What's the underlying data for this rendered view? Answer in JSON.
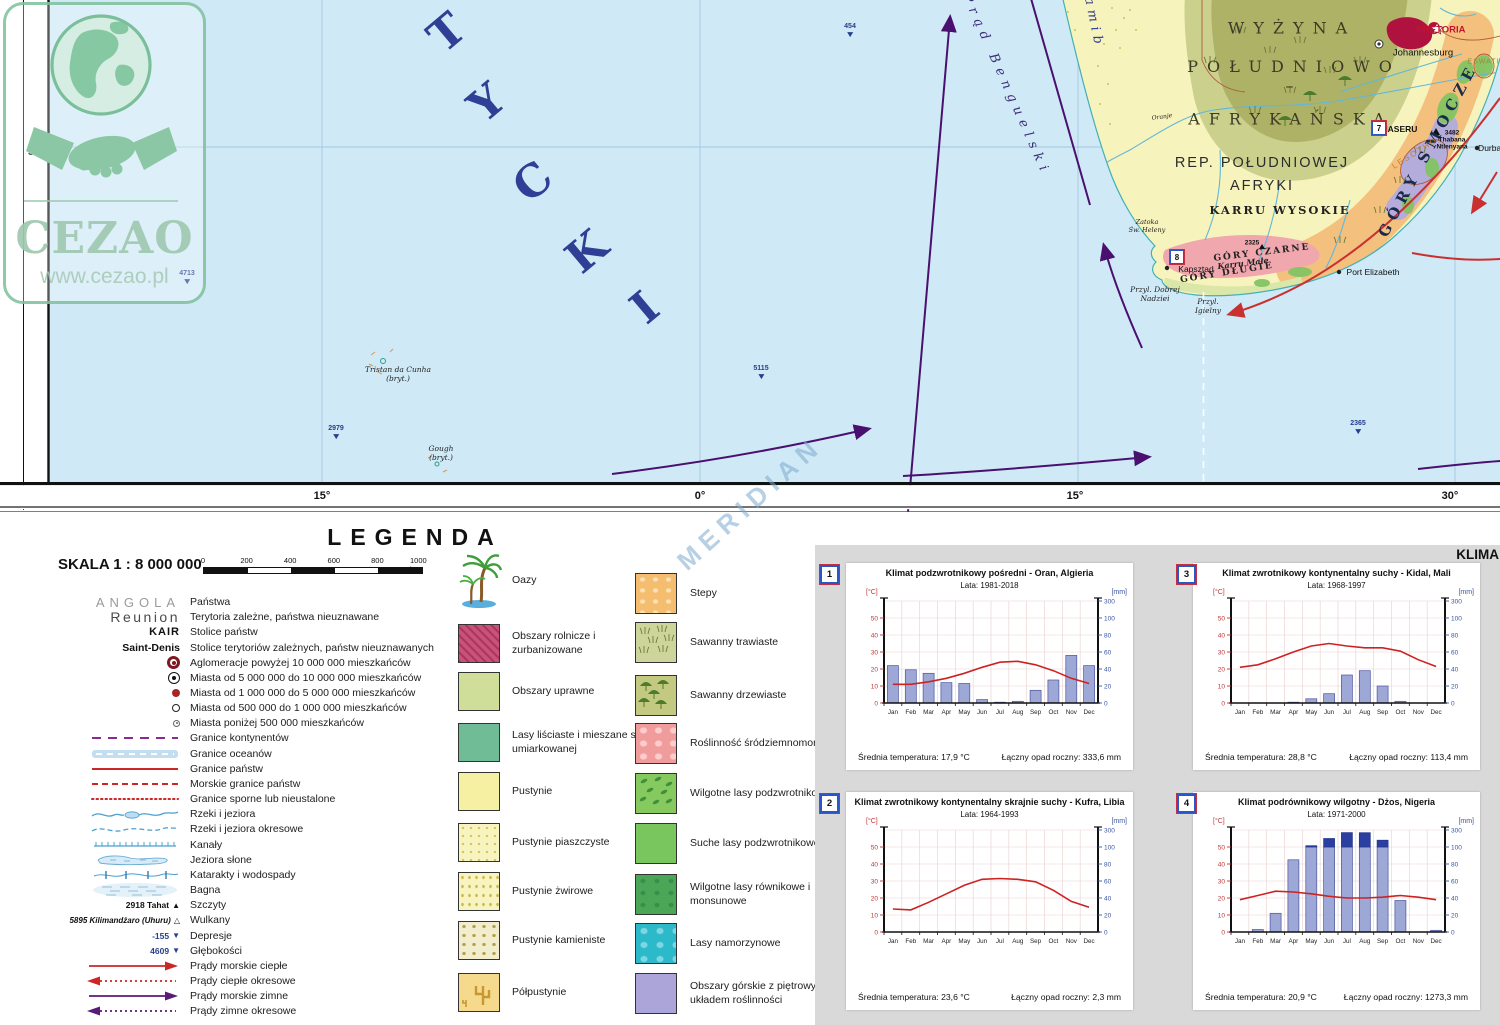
{
  "watermark": {
    "brand": "CEZAO",
    "url": "www.cezao.pl"
  },
  "meridian_watermark": "MERIDIAN",
  "map": {
    "ocean_letters": [
      "T",
      "Y",
      "C",
      "K",
      "I"
    ],
    "benguela_current": "Prąd Benguelski",
    "namib": "Namib",
    "wyzyna_1": "WYŻYNA",
    "wyzyna_2": "POŁUDNIOWO –",
    "wyzyna_3": "AFRYKAŃSKA",
    "rep_1": "REP. POŁUDNIOWEJ",
    "rep_2": "AFRYKI",
    "karru_wysokie": "KARRU WYSOKIE",
    "gory_smocze": "GÓRY SMOCZE",
    "gory_czarne": "GÓRY CZARNE",
    "karru_male": "Karru Małe",
    "gory_dlugie": "GÓRY DŁUGIE",
    "lesotho": "LESOTHO",
    "maseru": "MASERU",
    "eswatini": "ESWATINI",
    "pretoria": "PRETORIA",
    "johannesburg": "Johannesburg",
    "thabana": "3482\nThabana\nNtlenyana",
    "peak_2325": "2325",
    "durban": "Durban",
    "kapsztad": "Kapsztad",
    "port_elizabeth": "Port Elizabeth",
    "przyl_dobrej": "Przyl. Dobrej\nNadziei",
    "przyl_igielny": "Przyl.\nIgielny",
    "zatoka_heleny": "Zatoka\nŚw. Heleny",
    "oranje": "Oranje",
    "tristan": "Tristan da Cunha\n(bryt.)",
    "gough": "Gough\n(bryt.)",
    "depth_454": "454",
    "depth_4713": "4713",
    "depth_2979": "2979",
    "depth_5115": "5115",
    "depth_2365": "2365",
    "lat_30": "30°",
    "lon_15w": "15°",
    "lon_0": "0°",
    "lon_15e": "15°",
    "lon_30e": "30°",
    "marker_7": "7",
    "marker_8": "8"
  },
  "legend": {
    "title": "LEGENDA",
    "scale_label": "SKALA 1 : 8 000 000",
    "scalebar_ticks": [
      "0",
      "200",
      "400",
      "600",
      "800",
      "1000 km"
    ],
    "rows": [
      {
        "type": "country-name",
        "sample": "ANGOLA",
        "label": "Państwa"
      },
      {
        "type": "territory-name",
        "sample": "Reunion",
        "label": "Terytoria zależne, państwa nieuznawane"
      },
      {
        "type": "capital-name",
        "sample": "KAIR",
        "label": "Stolice państw"
      },
      {
        "type": "dep-capital-name",
        "sample": "Saint-Denis",
        "label": "Stolice terytoriów zależnych, państw nieuznawanych"
      },
      {
        "type": "city-10m",
        "label": "Aglomeracje powyżej 10 000 000 mieszkańców"
      },
      {
        "type": "city-5m",
        "label": "Miasta od 5 000 000 do 10 000 000 mieszkańców"
      },
      {
        "type": "city-1m",
        "label": "Miasta od 1 000 000 do 5 000 000 mieszkańców"
      },
      {
        "type": "city-500k",
        "label": "Miasta od 500 000  do 1 000 000 mieszkańców"
      },
      {
        "type": "city-sm",
        "label": "Miasta poniżej 500 000 mieszkańców"
      },
      {
        "type": "border-continent",
        "label": "Granice kontynentów"
      },
      {
        "type": "border-ocean",
        "label": "Granice oceanów"
      },
      {
        "type": "border-country",
        "label": "Granice państw"
      },
      {
        "type": "border-sea",
        "label": "Morskie granice państw"
      },
      {
        "type": "border-disputed",
        "label": "Granice sporne lub nieustalone"
      },
      {
        "type": "river",
        "label": "Rzeki i jeziora"
      },
      {
        "type": "river-seasonal",
        "label": "Rzeki i jeziora okresowe"
      },
      {
        "type": "canal",
        "label": "Kanały"
      },
      {
        "type": "salt-lake",
        "label": "Jeziora słone"
      },
      {
        "type": "waterfall",
        "label": "Katarakty i wodospady"
      },
      {
        "type": "swamp",
        "label": "Bagna"
      },
      {
        "type": "peak",
        "sample": "2918 Tahat",
        "label": "Szczyty"
      },
      {
        "type": "volcano",
        "sample": "5895 Kilimandżaro (Uhuru)",
        "label": "Wulkany"
      },
      {
        "type": "depression",
        "sample": "-155",
        "label": "Depresje"
      },
      {
        "type": "depth",
        "sample": "4609",
        "label": "Głębokości"
      },
      {
        "type": "current-warm",
        "label": "Prądy morskie ciepłe"
      },
      {
        "type": "current-warm-seasonal",
        "label": "Prądy ciepłe okresowe"
      },
      {
        "type": "current-cold",
        "label": "Prądy morskie zimne"
      },
      {
        "type": "current-cold-seasonal",
        "label": "Prądy zimne okresowe"
      }
    ],
    "veg_left": [
      {
        "type": "oasis",
        "label": "Oazy"
      },
      {
        "type": "agri",
        "label": "Obszary rolnicze i zurbanizowane"
      },
      {
        "type": "crops",
        "label": "Obszary uprawne"
      },
      {
        "type": "temperate",
        "label": "Lasy liściaste i mieszane strefy umiarkowanej"
      },
      {
        "type": "desert",
        "label": "Pustynie"
      },
      {
        "type": "sand",
        "label": "Pustynie piaszczyste"
      },
      {
        "type": "gravel",
        "label": "Pustynie żwirowe"
      },
      {
        "type": "stony",
        "label": "Pustynie kamieniste"
      },
      {
        "type": "semi",
        "label": "Półpustynie"
      }
    ],
    "veg_right": [
      {
        "type": "stepy",
        "label": "Stepy"
      },
      {
        "type": "savgrass",
        "label": "Sawanny trawiaste"
      },
      {
        "type": "savtree",
        "label": "Sawanny drzewiaste"
      },
      {
        "type": "medit",
        "label": "Roślinność śródziemnomorska"
      },
      {
        "type": "wetsub",
        "label": "Wilgotne lasy podzwrotnikowe"
      },
      {
        "type": "drysub",
        "label": "Suche lasy podzwrotnikowe"
      },
      {
        "type": "equat",
        "label": "Wilgotne lasy równikowe i monsunowe"
      },
      {
        "type": "mangrove",
        "label": "Lasy namorzynowe"
      },
      {
        "type": "mountain",
        "label": "Obszary górskie z piętrowym układem roślinności"
      }
    ]
  },
  "climate_panel": {
    "header": "KLIMA",
    "charts": [
      {
        "num": "1",
        "title": "Klimat podzwrotnikowy pośredni - Oran, Algieria",
        "years": "Lata: 1981-2018",
        "temp_unit": "[°C]",
        "precip_unit": "[mm]",
        "avg_temp": "Średnia temperatura: 17,9 °C",
        "annual_precip": "Łączny opad roczny: 333,6 mm"
      },
      {
        "num": "2",
        "title": "Klimat zwrotnikowy kontynentalny skrajnie suchy - Kufra, Libia",
        "years": "Lata: 1964-1993",
        "temp_unit": "[°C]",
        "precip_unit": "[mm]",
        "avg_temp": "Średnia temperatura: 23,6 °C",
        "annual_precip": "Łączny opad roczny: 2,3 mm"
      },
      {
        "num": "3",
        "title": "Klimat zwrotnikowy kontynentalny suchy - Kidal, Mali",
        "years": "Lata: 1968-1997",
        "temp_unit": "[°C]",
        "precip_unit": "[mm]",
        "avg_temp": "Średnia temperatura: 28,8 °C",
        "annual_precip": "Łączny opad roczny: 113,4 mm"
      },
      {
        "num": "4",
        "title": "Klimat podrównikowy wilgotny - Dżos, Nigeria",
        "years": "Lata: 1971-2000",
        "temp_unit": "[°C]",
        "precip_unit": "[mm]",
        "avg_temp": "Średnia temperatura: 20,9 °C",
        "annual_precip": "Łączny opad roczny: 1273,3 mm"
      }
    ]
  },
  "chart_data": [
    {
      "type": "climograph",
      "station": "Oran, Algieria",
      "months": [
        "Jan",
        "Feb",
        "Mar",
        "Apr",
        "May",
        "Jun",
        "Jul",
        "Aug",
        "Sep",
        "Oct",
        "Nov",
        "Dec"
      ],
      "temp_c": [
        11,
        11,
        12.5,
        14.5,
        17.5,
        21,
        24,
        24.5,
        22.5,
        19,
        14.5,
        11.5
      ],
      "precip_mm": [
        44,
        39,
        35,
        24,
        23,
        4,
        1,
        2,
        15,
        27,
        56,
        44
      ],
      "temp_ticks": [
        0,
        10,
        20,
        30,
        40,
        50
      ],
      "precip_ticks": [
        0,
        20,
        40,
        60,
        80,
        100,
        300
      ]
    },
    {
      "type": "climograph",
      "station": "Kufra, Libia",
      "months": [
        "Jan",
        "Feb",
        "Mar",
        "Apr",
        "May",
        "Jun",
        "Jul",
        "Aug",
        "Sep",
        "Oct",
        "Nov",
        "Dec"
      ],
      "temp_c": [
        13.5,
        13,
        17.5,
        22.5,
        27.5,
        31,
        31.5,
        31,
        29.5,
        24.5,
        18,
        14.5
      ],
      "precip_mm": [
        0,
        0,
        0,
        0,
        0,
        0,
        0,
        0,
        0,
        0,
        0,
        0
      ],
      "temp_ticks": [
        0,
        10,
        20,
        30,
        40,
        50
      ],
      "precip_ticks": [
        0,
        20,
        40,
        60,
        80,
        100,
        300
      ]
    },
    {
      "type": "climograph",
      "station": "Kidal, Mali",
      "months": [
        "Jan",
        "Feb",
        "Mar",
        "Apr",
        "May",
        "Jun",
        "Jul",
        "Aug",
        "Sep",
        "Oct",
        "Nov",
        "Dec"
      ],
      "temp_c": [
        21,
        22.5,
        26,
        30,
        33.5,
        35,
        33.5,
        32.5,
        32.5,
        30.5,
        25.5,
        21.5
      ],
      "precip_mm": [
        0,
        0,
        0,
        1,
        5,
        11,
        33,
        38,
        20,
        2,
        0,
        0
      ],
      "temp_ticks": [
        0,
        10,
        20,
        30,
        40,
        50
      ],
      "precip_ticks": [
        0,
        20,
        40,
        60,
        80,
        100,
        300
      ]
    },
    {
      "type": "climograph",
      "station": "Dżos, Nigeria",
      "months": [
        "Jan",
        "Feb",
        "Mar",
        "Apr",
        "May",
        "Jun",
        "Jul",
        "Aug",
        "Sep",
        "Oct",
        "Nov",
        "Dec"
      ],
      "temp_c": [
        19,
        21.5,
        24,
        23.5,
        22.5,
        21,
        20,
        20,
        20.5,
        21.5,
        20.5,
        19
      ],
      "precip_mm": [
        0,
        3,
        22,
        85,
        115,
        200,
        270,
        268,
        180,
        37,
        0,
        2
      ],
      "temp_ticks": [
        0,
        10,
        20,
        30,
        40,
        50
      ],
      "precip_ticks": [
        0,
        20,
        40,
        60,
        80,
        100,
        300
      ]
    }
  ]
}
